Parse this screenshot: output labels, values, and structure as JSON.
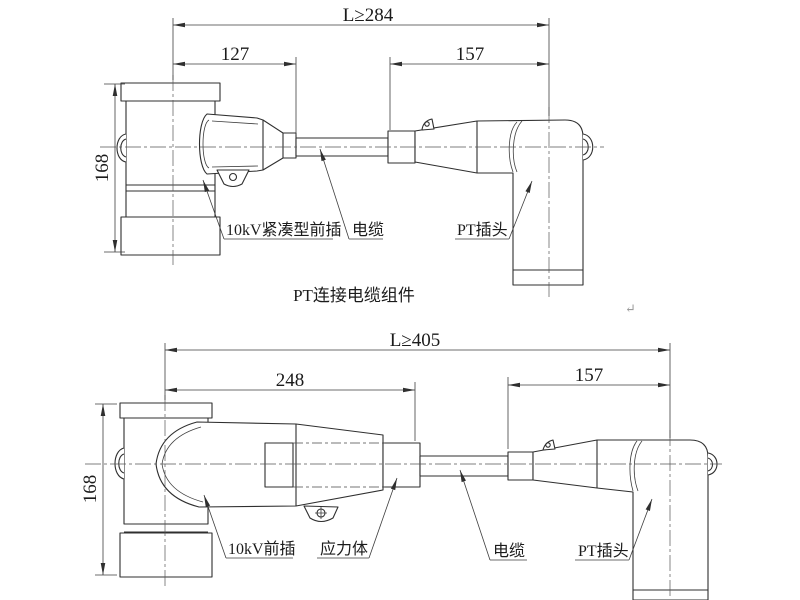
{
  "colors": {
    "background": "#ffffff",
    "object_line": "#2f2f2f",
    "dimension_line": "#3e3e3e",
    "centerline": "#555555",
    "text": "#1b1b1b",
    "stray_mark": "#9a9a9a"
  },
  "top_view": {
    "dim_overall": "L≥284",
    "dim_front": "127",
    "dim_plug": "157",
    "dim_height": "168",
    "label_front_plug": "10kV紧凑型前插",
    "label_cable": "电缆",
    "label_pt_plug": "PT插头",
    "caption": "PT连接电缆组件"
  },
  "bottom_view": {
    "dim_overall": "L≥405",
    "dim_front": "248",
    "dim_plug": "157",
    "dim_height": "168",
    "label_front_plug": "10kV前插",
    "label_stress_cone": "应力体",
    "label_cable": "电缆",
    "label_pt_plug": "PT插头"
  },
  "stray_mark": "↵"
}
